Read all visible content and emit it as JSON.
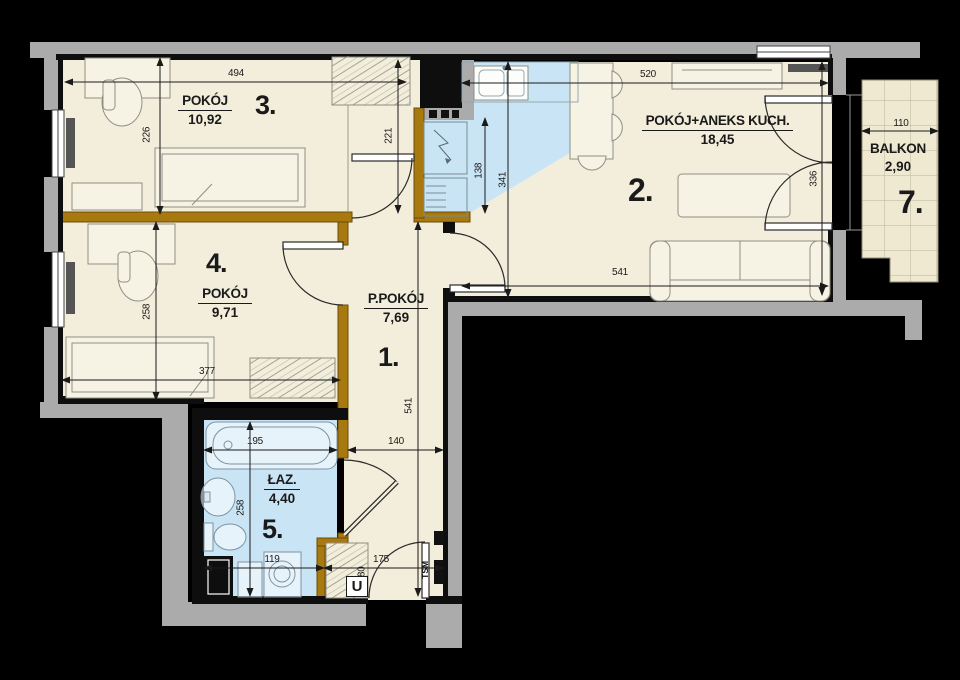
{
  "plan": {
    "rooms": [
      {
        "key": "room3",
        "number": "3.",
        "name": "POKÓJ",
        "area": "10,92"
      },
      {
        "key": "room2",
        "number": "2.",
        "name": "POKÓJ+ANEKS KUCH.",
        "area": "18,45"
      },
      {
        "key": "room4",
        "number": "4.",
        "name": "POKÓJ",
        "area": "9,71"
      },
      {
        "key": "room1",
        "number": "1.",
        "name": "P.POKÓJ",
        "area": "7,69"
      },
      {
        "key": "room5",
        "number": "5.",
        "name": "ŁAZ.",
        "area": "4,40"
      },
      {
        "key": "room7",
        "number": "7.",
        "name": "BALKON",
        "area": "2,90"
      }
    ],
    "dimensions": {
      "room3_width": "494",
      "room3_left_height": "226",
      "room3_right_height": "221",
      "room2_top_width": "520",
      "kitchen_depth": "138",
      "room2_left_height": "341",
      "room2_right_height": "336",
      "room2_bottom_width": "541",
      "hall_length": "541",
      "hall_width": "140",
      "bath_top_width": "195",
      "bath_height": "258",
      "bath_bottom_width": "119",
      "room4_height": "258",
      "room4_width": "377",
      "entry_width": "175",
      "entry_door_width": "80",
      "balcony_width": "110"
    },
    "annotations": {
      "wardrobe": "U",
      "meter_box": "TSM"
    },
    "colors": {
      "floor": "#f3eedb",
      "wet_zone": "#c9e4f4",
      "wall_brown": "#a8790f",
      "wall_gray": "#ababab",
      "wall_black": "#0e0e0e",
      "balcony_tile": "#efe9d2"
    }
  }
}
